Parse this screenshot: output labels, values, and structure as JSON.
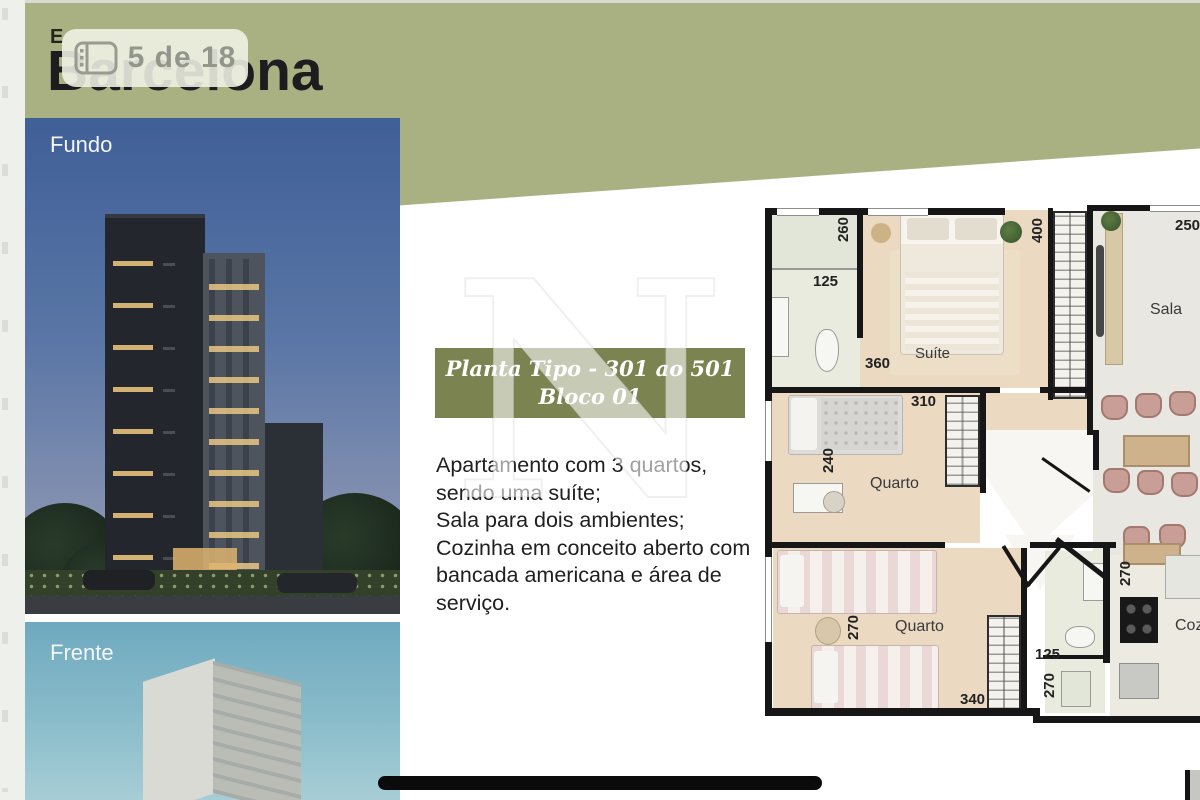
{
  "viewer": {
    "counter": "5 de 18"
  },
  "header": {
    "eyebrow": "E",
    "title": "Barcelona"
  },
  "photos": {
    "back_label": "Fundo",
    "front_label": "Frente"
  },
  "banner": {
    "line1": "Planta Tipo - 301 ao 501",
    "line2": "Bloco 01"
  },
  "watermark": {
    "letter": "N"
  },
  "description": {
    "line1": "Apartamento com 3 quartos,",
    "line2": "sendo uma suíte;",
    "line3": "Sala para dois ambientes;",
    "line4": "Cozinha em conceito aberto com",
    "line5": "bancada americana e  área de",
    "line6": "serviço."
  },
  "floorplan": {
    "rooms": {
      "suite": "Suíte",
      "bedroom1": "Quarto",
      "bedroom2": "Quarto",
      "living": "Sala",
      "kitchen": "Coz"
    },
    "dims": {
      "suite_bath_height": "260",
      "suite_bath_width": "125",
      "suite_height": "400",
      "suite_width": "360",
      "living_width": "250",
      "bedroom1_width": "310",
      "bedroom1_height": "240",
      "bedroom2_height": "270",
      "bedroom2_width": "340",
      "bath2_width": "125",
      "bath2_height": "270",
      "kitchen_height": "270"
    }
  },
  "colors": {
    "olive_band": "#a9b183",
    "banner_green": "#7b8351",
    "title_text": "#1d1d1f",
    "badge_text": "#93968b"
  }
}
